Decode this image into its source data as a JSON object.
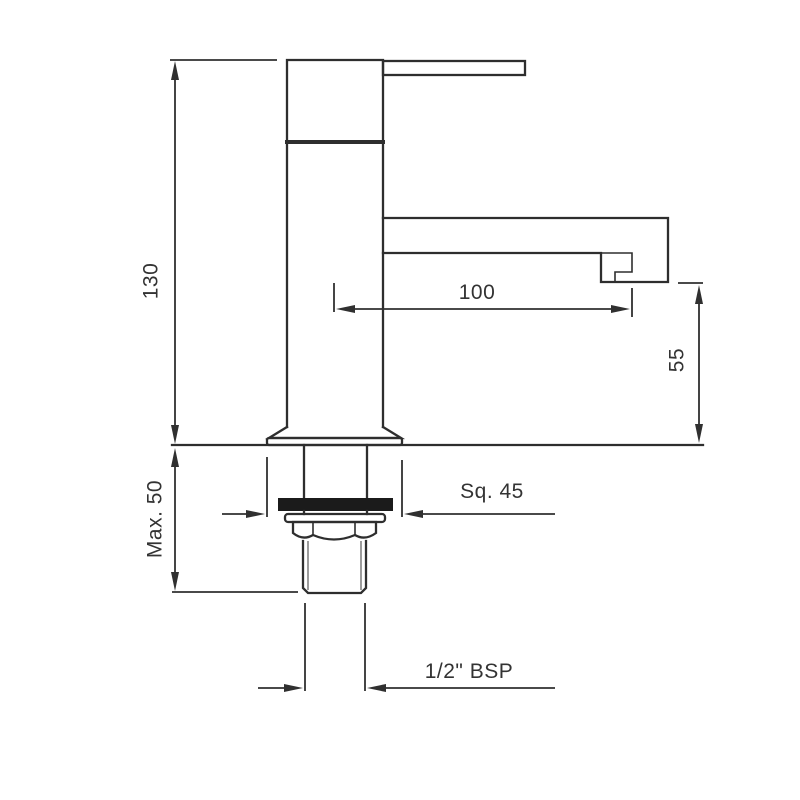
{
  "drawing": {
    "type": "technical-dimension-drawing",
    "subject": "single-lever basin tap, side elevation with installation dimensions",
    "labels": {
      "overall_height": "130",
      "spout_reach": "100",
      "spout_height": "55",
      "max_deck_thickness": "Max. 50",
      "base_square": "Sq. 45",
      "inlet_thread": "1/2\" BSP"
    },
    "colors": {
      "line": "#2e2e2e",
      "dimension_line": "#303030",
      "text": "#333333",
      "gasket_fill": "#1b1b1b",
      "background": "#ffffff"
    }
  }
}
